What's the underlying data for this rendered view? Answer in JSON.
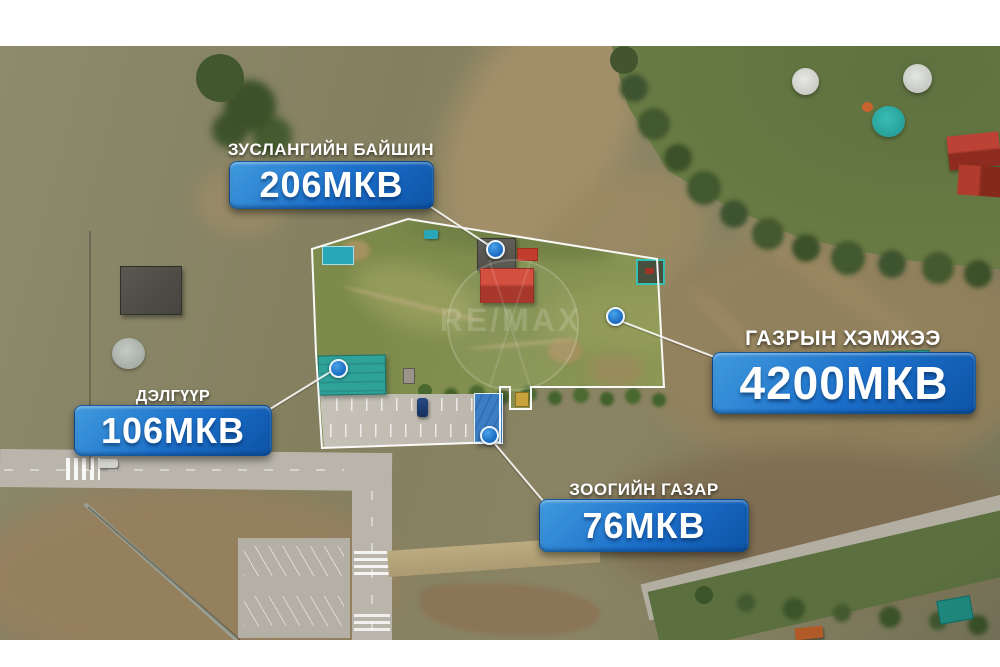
{
  "watermark": {
    "brand": "RE/MAX"
  },
  "annotations": {
    "summer_house": {
      "title": "ЗУСЛАНГИЙН БАЙШИН",
      "area": "206МКВ"
    },
    "land": {
      "title": "ГАЗРЫН ХЭМЖЭЭ",
      "area": "4200МКВ"
    },
    "shop": {
      "title": "ДЭЛГҮҮР",
      "area": "106МКВ"
    },
    "restaurant": {
      "title": "ЗООГИЙН ГАЗАР",
      "area": "76МКВ"
    }
  },
  "colors": {
    "badge_gradient_start": "#419add",
    "badge_gradient_end": "#0d54a6",
    "boundary_line": "#ffffff",
    "marker_fill": "#1f78d4",
    "summer_house_roof": "#c6392b",
    "shop_roof": "#2fa39a",
    "restaurant_roof": "#3b7ec4",
    "frame": "#ffffff"
  }
}
